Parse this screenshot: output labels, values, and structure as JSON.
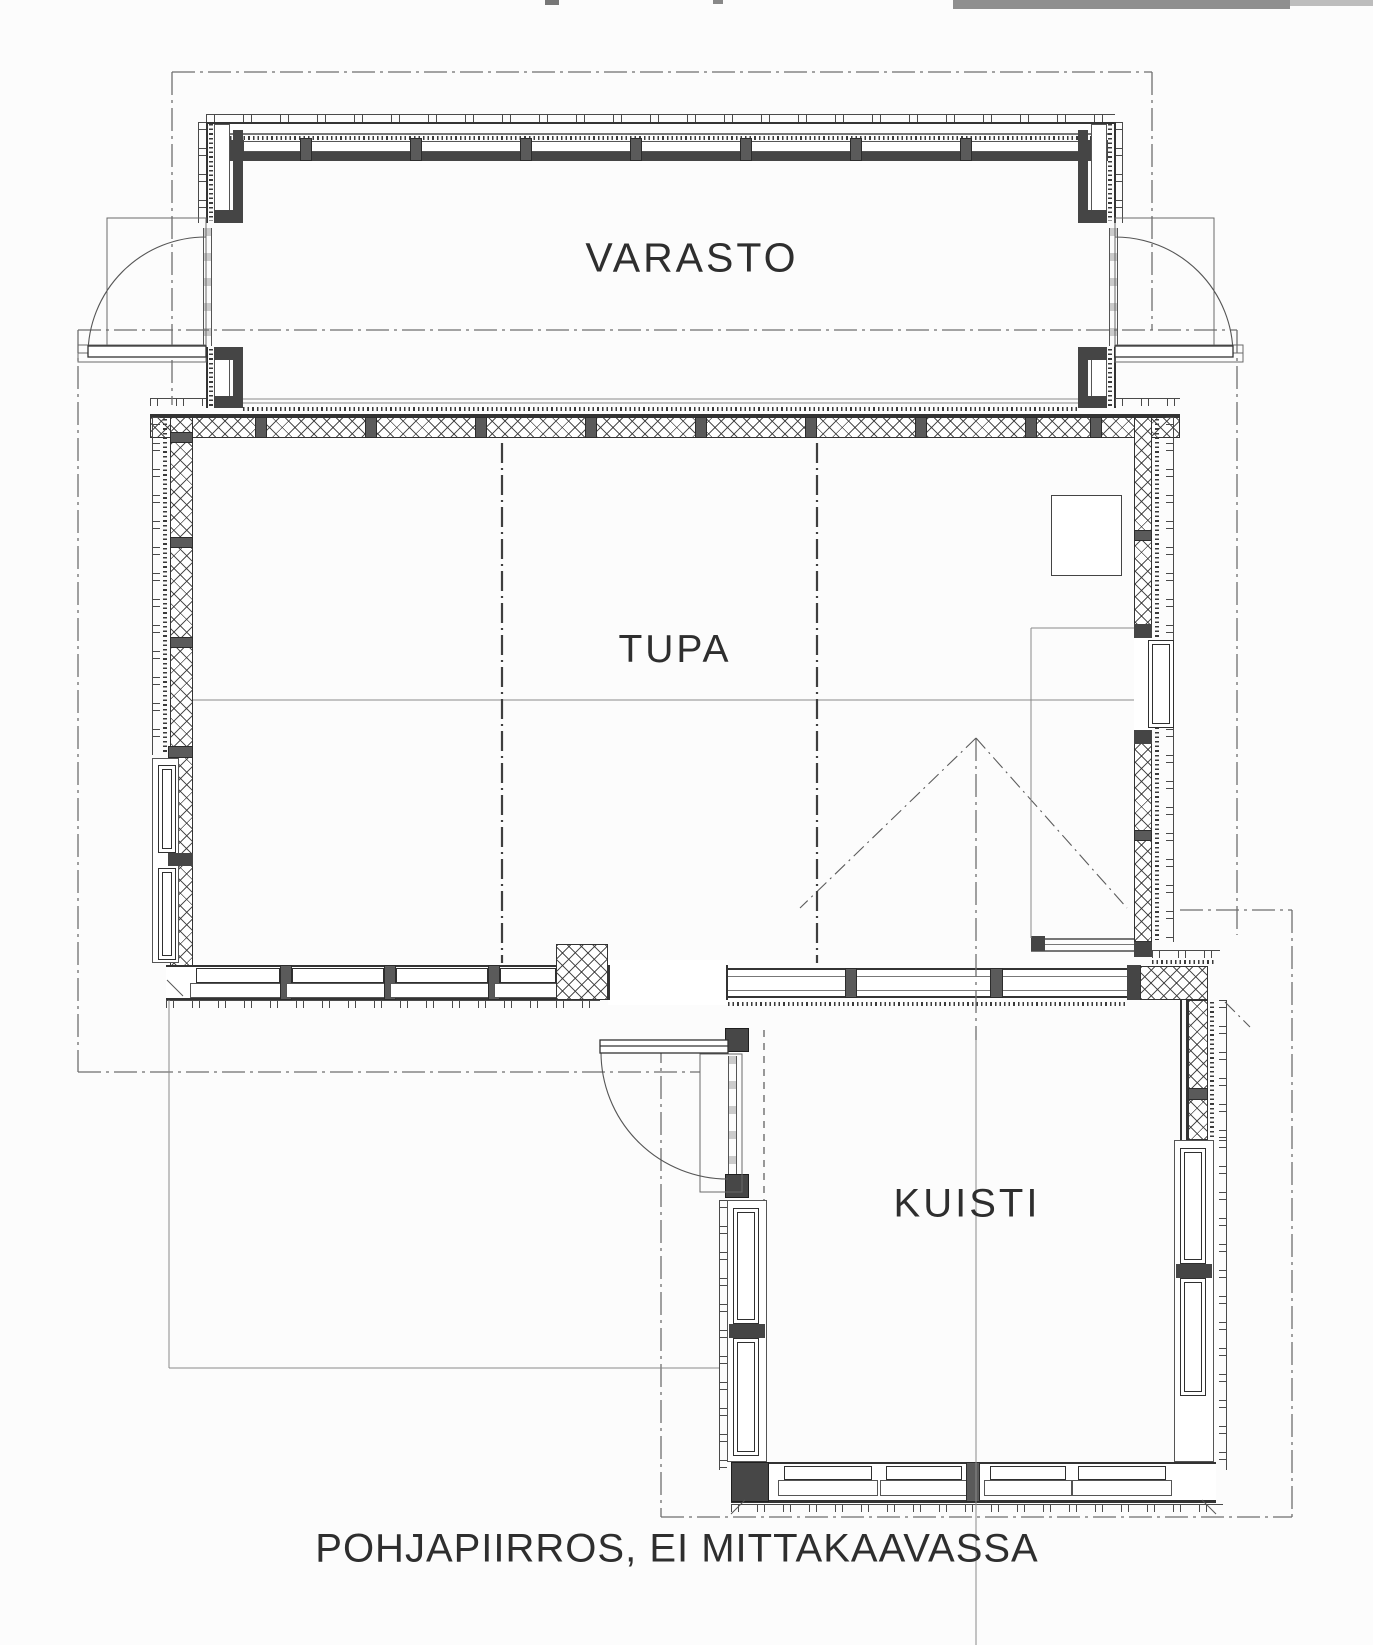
{
  "rooms": [
    {
      "name": "VARASTO"
    },
    {
      "name": "TUPA"
    },
    {
      "name": "KUISTI"
    }
  ],
  "caption": "POHJAPIIRROS, EI MITTAKAAVASSA",
  "colors": {
    "paper": "#fcfcfc",
    "ink": "#2e2e2e",
    "wall_line": "#333333",
    "stud_gray": "#5a5a5a",
    "post_gray": "#474747",
    "chain_line": "#6e6e6e",
    "scanner_strip": "#8f8f8f"
  }
}
